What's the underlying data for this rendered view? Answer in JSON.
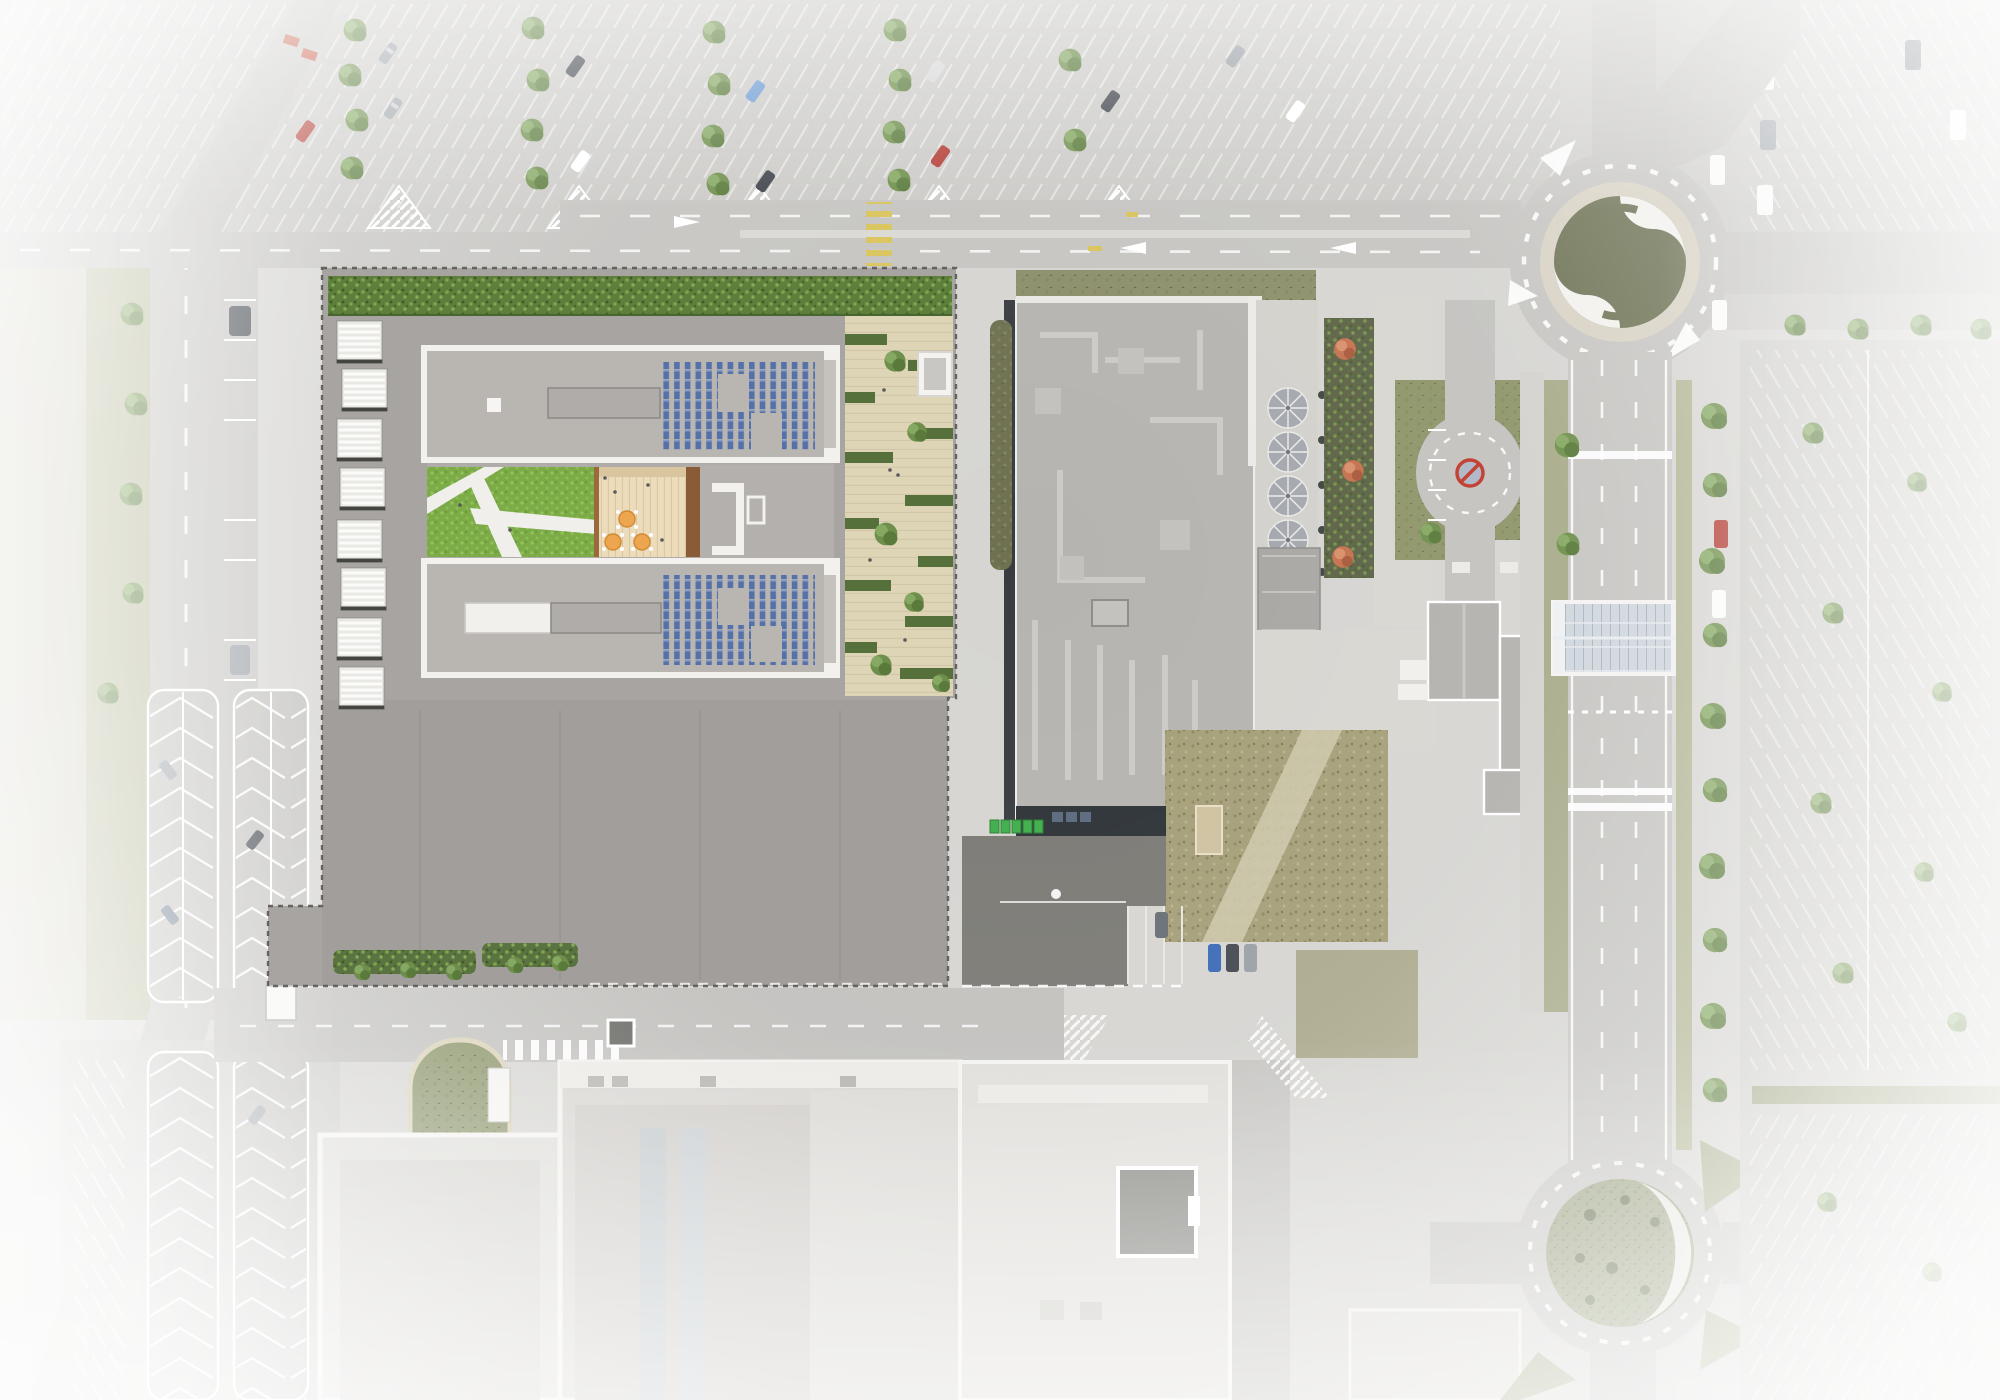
{
  "meta": {
    "kind": "aerial-site-plan-photomontage",
    "description": "Top-down aerial view: architectural render of a new solar-roofed building with courtyard inserted into an existing commercial area; surroundings faded to white (parking lots, boulevard, two roundabouts, glazed footbridge, big-box building)."
  },
  "palette": {
    "ground": "#d6d5d2",
    "asphalt": "#c6c5c2",
    "lot_asphalt": "#cbcac7",
    "site_plate": "#a7a4a1",
    "site_parking": "#a19e9b",
    "roof_wing": "#b9b5b1",
    "parapet_white": "#f2f1ee",
    "solar_blue": "#5571a9",
    "solar_light": "#8398c4",
    "grass": "#7cab47",
    "green_roof": "#5d7f3c",
    "terrace": "#ded4b6",
    "deck": "#ecdcbb",
    "deck_frame": "#8a5c36",
    "table_orange": "#eea54f",
    "hedge": "#55703a",
    "existing_roof": "#b6b4b0",
    "duct_light": "#cdccc8",
    "dark_edge": "#383c40",
    "dark_yard": "#7b7a75",
    "dry_field": "#a59f79",
    "swirl_olive": "#6e7355",
    "swirl_white": "#f2f1ee",
    "gravel": "#d8d2c4",
    "roundabout_green": "#99a07f",
    "glass_bridge": "#cfd6dd",
    "verge_green": "#b4b796",
    "tree_green": "#6e8f4b",
    "tree_orange": "#c4714e",
    "bin_green": "#3fae4a",
    "marking_white": "#ffffff",
    "marking_yellow": "#d9c45c",
    "concrete_walk": "#d8d6d1",
    "white_building": "#dddcd8",
    "basin_green": "#8a9468"
  },
  "render_site": {
    "solar_arrays": 2,
    "solar_notches_per_array": 2,
    "bike_shelters": 8,
    "courtyard_tables": 3,
    "terrace_planter_rows": 10,
    "landscape_strips_south": 2
  },
  "roundabouts": [
    {
      "name": "north-roundabout",
      "motif": "olive and white swirl logo on gravel island"
    },
    {
      "name": "south-roundabout",
      "motif": "green island with white crescent and shrubs"
    }
  ],
  "footbridge": {
    "kind": "glazed covered walkway crossing east avenue"
  },
  "existing_building": {
    "rooftop": "HVAC ducts and units",
    "east_terrace_umbrellas": 4,
    "loading_bins_green": 5
  },
  "regions": [
    {
      "name": "top-parking-lot",
      "kind": "parking"
    },
    {
      "name": "northeast-parking-lot",
      "kind": "parking"
    },
    {
      "name": "east-parking-lot",
      "kind": "parking"
    },
    {
      "name": "west-street",
      "kind": "road"
    },
    {
      "name": "west-chevron-parking",
      "kind": "parking"
    },
    {
      "name": "boulevard-road",
      "kind": "road"
    },
    {
      "name": "east-avenue",
      "kind": "road"
    },
    {
      "name": "south-road",
      "kind": "road"
    },
    {
      "name": "south-buildings",
      "kind": "buildings"
    },
    {
      "name": "existing-building-complex",
      "kind": "building"
    },
    {
      "name": "render-site",
      "kind": "proposed-building"
    }
  ]
}
